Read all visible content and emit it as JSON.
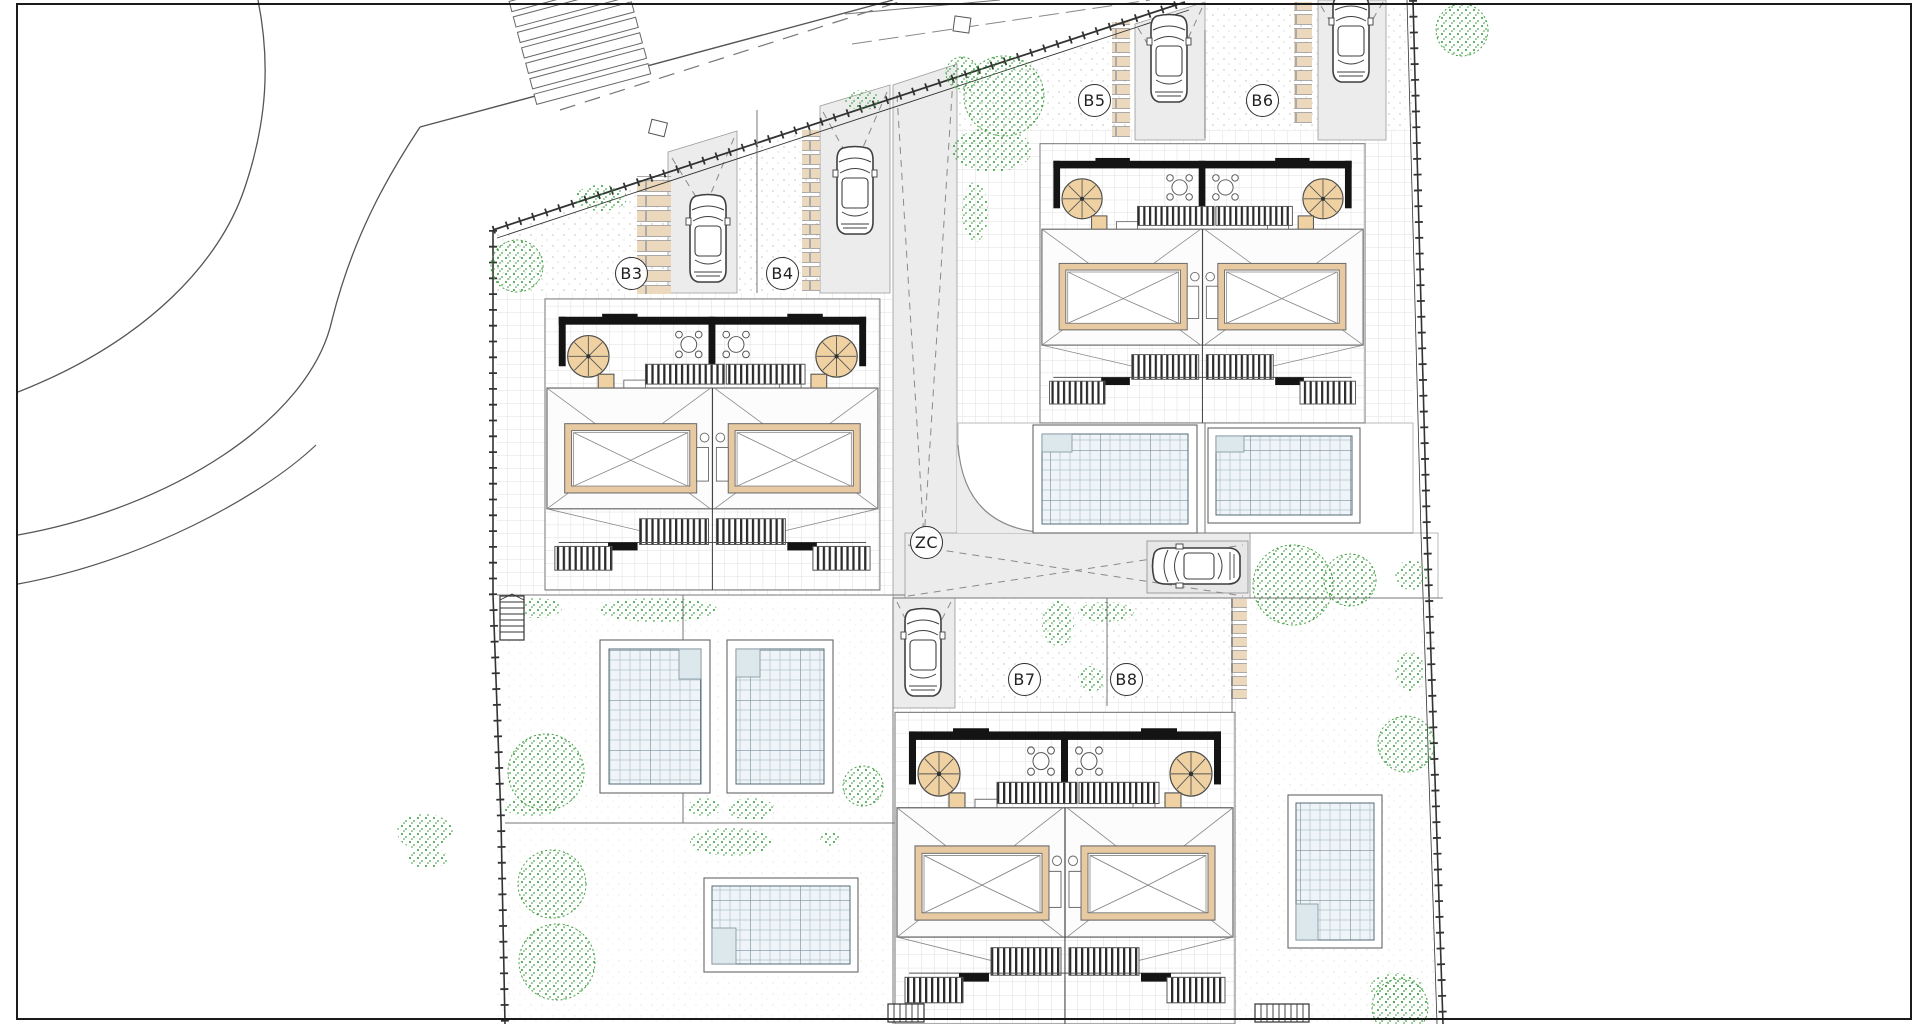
{
  "site_plan": {
    "lot_labels": [
      {
        "text": "B3"
      },
      {
        "text": "B4"
      },
      {
        "text": "B5"
      },
      {
        "text": "B6"
      },
      {
        "text": "B7"
      },
      {
        "text": "B8"
      }
    ],
    "zone_label": {
      "text": "ZC"
    },
    "colors": {
      "paper": "#ffffff",
      "line": "#4a4a4a",
      "wall_dark": "#141414",
      "stepping_stone": "#ecd8bc",
      "spiral_stair_tan": "#f0d2a2",
      "skylight_frame_tan": "#e7c9a2",
      "tree_green": "#2f9e36",
      "pool_water": "#eef4f7",
      "pool_grid": "#7d929c",
      "pavement_gray": "#ececec",
      "tile_line": "#d6d6d6"
    },
    "icons": {
      "car": "car-top-view-icon",
      "tree": "tree-icon",
      "shrub": "shrub-icon",
      "spiral_stair": "spiral-stair-icon",
      "pool": "swimming-pool-icon",
      "stepping_stones": "stepping-stones-icon",
      "crosswalk": "zebra-crossing-icon",
      "stairs": "stairs-icon",
      "patio_table": "patio-table-icon"
    }
  }
}
